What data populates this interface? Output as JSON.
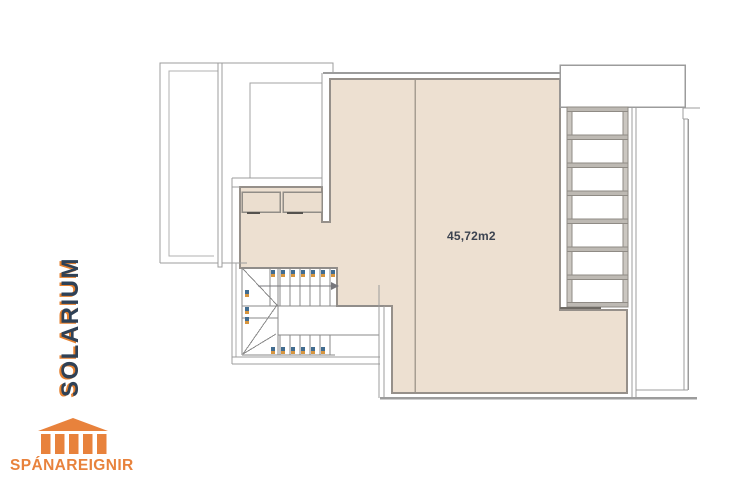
{
  "plan": {
    "title": "SOLARIUM",
    "area_label": "45,72m2",
    "colors": {
      "deck_fill": "#EDE0D1",
      "wall_line": "#9C9C9C",
      "stair_line": "#8A8A8A",
      "title_navy": "#2F4156",
      "accent_orange": "#E8823C",
      "step_mark_blue": "#416C90",
      "step_mark_orange": "#D6953F"
    }
  },
  "branding": {
    "logo_text": "SPÁNAREIGNIR",
    "logo_icon": "temple-icon"
  }
}
